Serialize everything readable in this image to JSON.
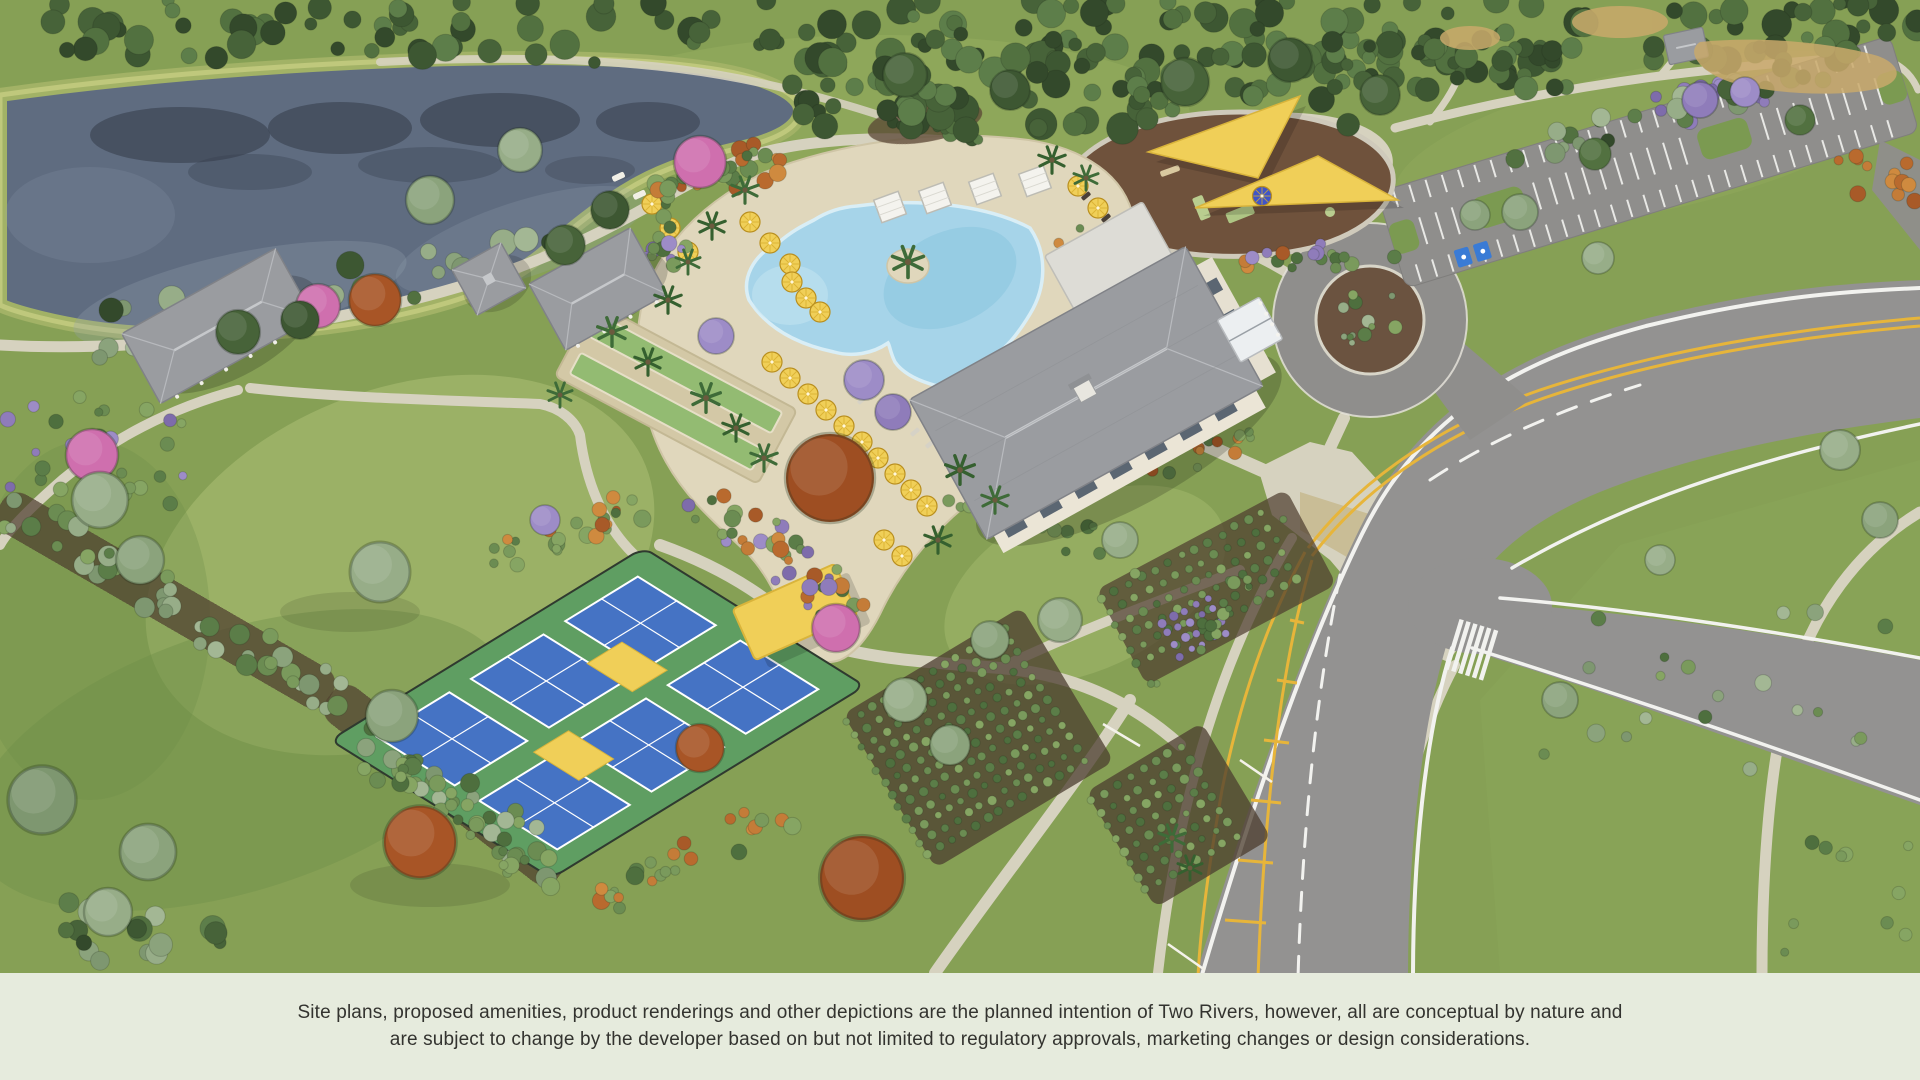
{
  "disclaimer": {
    "line1": "Site plans, proposed amenities, product renderings and other depictions are the planned intention of Two Rivers, however, all are conceptual by nature and",
    "line2": "are subject to change by the developer based on but not limited to regulatory approvals, marketing changes or design considerations."
  },
  "palette": {
    "band": "#e6ebdd",
    "text": "#33332f",
    "grass": "#86a055",
    "grassLight": "#9db368",
    "grassMid": "#8fa75b",
    "grassDark": "#6e8e48",
    "water": "#5f6c80",
    "waterDark": "#37404c",
    "waterLight": "#97a2b0",
    "bank": "#a2b266",
    "bankLight": "#c2ca7e",
    "path": "#d6d2bf",
    "deck": "#e0d7bc",
    "deckEdge": "#cfc5a6",
    "pool": "#a6d4e9",
    "poolDeep": "#8cc6e0",
    "poolEdge": "#d9eef6",
    "road": "#939291",
    "asphalt": "#8f8e8c",
    "lineWhite": "#f2f2ef",
    "lineYellow": "#e7b53a",
    "roof": "#9a9ca0",
    "roofLight": "#c6c8cb",
    "roofDark": "#808287",
    "wall": "#ebe5d6",
    "window": "#5b6672",
    "canopy": "#f0cf58",
    "canopyEdge": "#d9b43b",
    "courtBlue": "#4573c4",
    "courtGreen": "#5f9e62",
    "mulch": "#4e3e2f",
    "playMulch": "#6f523c",
    "sand": "#c9a96b",
    "blueUmbrella": "#4054c7",
    "handicapBlue": "#3a7bd5"
  }
}
